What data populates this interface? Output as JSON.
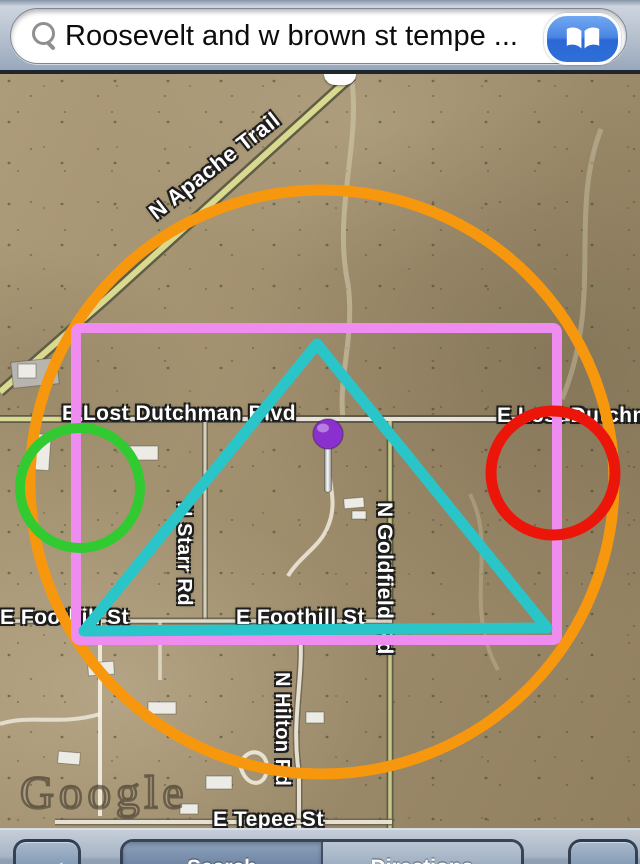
{
  "search_bar": {
    "query": "Roosevelt and w brown st tempe ...",
    "search_icon": "magnifier-icon",
    "bookmarks_icon": "open-book-icon"
  },
  "map": {
    "watermark": "Google",
    "street_labels": [
      {
        "text": "N Apache Trail",
        "x": 152,
        "y": 128,
        "size": 22,
        "rotate": -38,
        "vertical": false
      },
      {
        "text": "E Lost Dutchman Blvd",
        "x": 62,
        "y": 328,
        "size": 21,
        "rotate": 0,
        "vertical": false
      },
      {
        "text": "E Lost Dutchman Blvd",
        "x": 497,
        "y": 330,
        "size": 21,
        "rotate": 0,
        "vertical": false
      },
      {
        "text": "N Starr Rd",
        "x": 172,
        "y": 428,
        "size": 20,
        "rotate": 0,
        "vertical": true
      },
      {
        "text": "E Foothill St",
        "x": 0,
        "y": 532,
        "size": 21,
        "rotate": 0,
        "vertical": false
      },
      {
        "text": "E Foothill St",
        "x": 236,
        "y": 532,
        "size": 21,
        "rotate": 0,
        "vertical": false
      },
      {
        "text": "N Goldfield Rd",
        "x": 372,
        "y": 428,
        "size": 21,
        "rotate": 0,
        "vertical": true
      },
      {
        "text": "N Hilton Rd",
        "x": 270,
        "y": 598,
        "size": 20,
        "rotate": 0,
        "vertical": true
      },
      {
        "text": "E Tepee St",
        "x": 213,
        "y": 734,
        "size": 21,
        "rotate": 0,
        "vertical": false
      }
    ],
    "annotations": [
      {
        "id": "orange-circle",
        "type": "circle",
        "cx": 322,
        "cy": 408,
        "r": 292,
        "color": "#F7970E",
        "stroke_width": 11
      },
      {
        "id": "pink-rectangle",
        "type": "rect",
        "x": 76,
        "y": 254,
        "width": 481,
        "height": 312,
        "color": "#EF8CEF",
        "stroke_width": 10
      },
      {
        "id": "cyan-triangle",
        "type": "polygon",
        "points": [
          [
            317,
            270
          ],
          [
            84,
            557
          ],
          [
            547,
            554
          ]
        ],
        "color": "#29C5C9",
        "stroke_width": 11
      },
      {
        "id": "green-circle",
        "type": "circle",
        "cx": 80,
        "cy": 414,
        "r": 60,
        "color": "#31CB31",
        "stroke_width": 10
      },
      {
        "id": "red-circle",
        "type": "circle",
        "cx": 553,
        "cy": 399,
        "r": 62,
        "color": "#EB150A",
        "stroke_width": 11
      },
      {
        "id": "purple-pin",
        "type": "pin",
        "cx": 328,
        "cy": 360,
        "r": 15,
        "stem_bottom": 418,
        "color": "#8A30CE"
      }
    ]
  },
  "toolbar": {
    "tracking_icon": "location-arrow-icon",
    "page_curl_icon": "page-curl-icon",
    "segments": [
      {
        "label": "Search",
        "selected": true
      },
      {
        "label": "Directions",
        "selected": false
      }
    ]
  }
}
